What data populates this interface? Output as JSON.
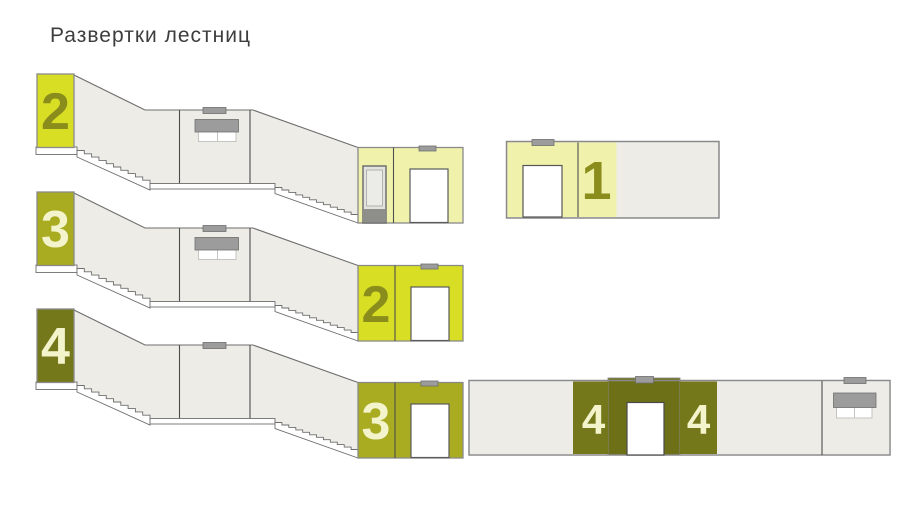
{
  "title": "Развертки лестниц",
  "palette": {
    "bright_green": "#d8de24",
    "olive_green": "#a9ab20",
    "dark_olive": "#75781a",
    "dark_olive_deep": "#6d7017",
    "pale_yellow": "#f0f2ac",
    "numeral_olive": "#8a8c1b",
    "numeral_cream": "#f3f4cb",
    "wall_fill": "#edece7",
    "blind_gray": "#9c9c9c"
  },
  "stair_runs": [
    {
      "level_label": "2"
    },
    {
      "level_label": "3",
      "landing_label": "2"
    },
    {
      "level_label": "4",
      "landing_label": "3"
    }
  ],
  "floor_elevations": {
    "first": {
      "label": "1"
    },
    "fourth": {
      "left_label": "4",
      "right_label": "4"
    }
  }
}
